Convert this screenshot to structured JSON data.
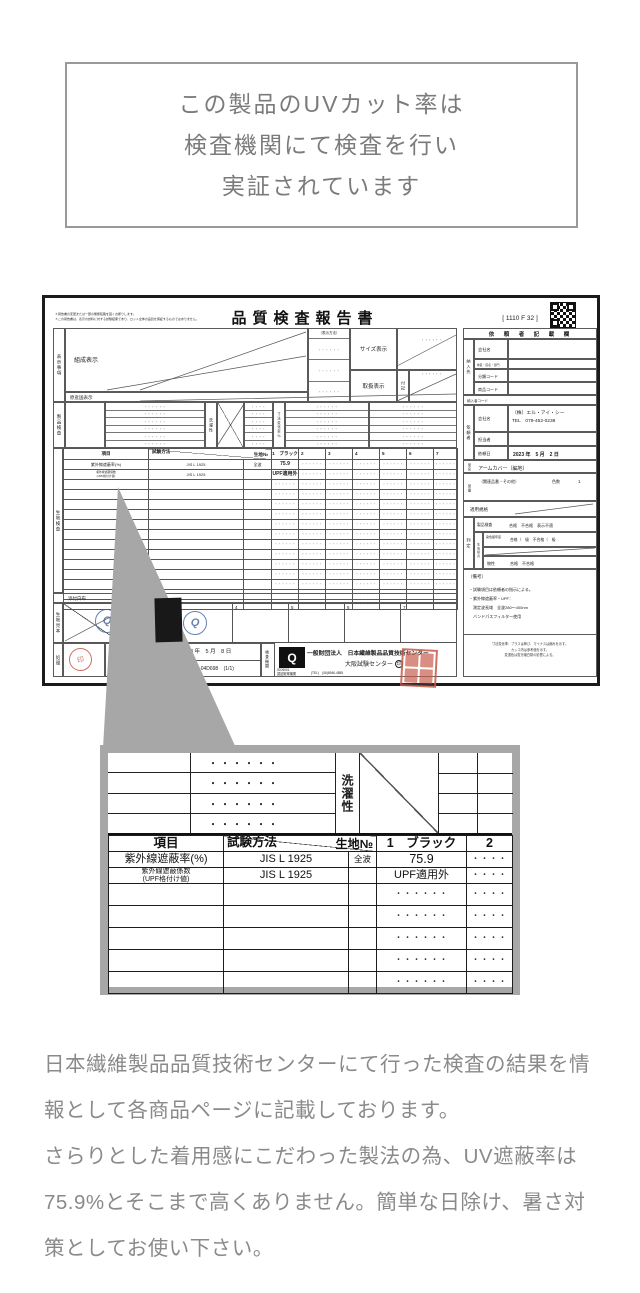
{
  "colors": {
    "frame_gray": "#a7a7a7",
    "text_gray": "#8a8a8a",
    "doc_border": "#1b1b1b",
    "stamp_red": "#c75948",
    "stamp_blue": "#40659a",
    "swatch_black": "#181818"
  },
  "intro_box": {
    "lines": [
      "この製品のUVカット率は",
      "検査機関にて検査を行い",
      "実証されています"
    ]
  },
  "report": {
    "title": "品質検査報告書",
    "form_code": "[ 1110 F 32 ]",
    "fine_print": [
      "＊報告書の変更または一部の無断転載を固くお断りします。",
      "＊この報告書は、表示の試料に対する試験結果であり、ロット全体の品質を保証するものではありません。"
    ],
    "labels": {
      "hyoji_jiko": "表示事項",
      "kosei": "組成表示",
      "gensankoku": "原産国表示",
      "hyoji_hoho": "（表示方法）",
      "size": "サイズ表示",
      "toriatsukai": "取扱表示",
      "fuki": "付記",
      "seihin_kensa": "製品検査",
      "sentakusei": "洗濯性",
      "sunpo": "寸法変化率％",
      "kiji_kensa": "生地検査",
      "tenpu": "添付白布",
      "kiji_mihon": "生地見本",
      "shori": "処理",
      "kensa_kikan": "検査機関"
    },
    "test_table": {
      "headers": {
        "item": "項目",
        "method": "試験方法",
        "fabric_no": "生地№",
        "col1": "1　ブラック",
        "cols": [
          "2",
          "3",
          "4",
          "5",
          "6",
          "7"
        ]
      },
      "rows": [
        {
          "item": "紫外線遮蔽率(%)",
          "method": "JIS L 1925",
          "sub": "全波",
          "value": "75.9"
        },
        {
          "item": "紫外線遮蔽係数",
          "item2": "(UPF格付け値)",
          "method": "JIS L 1925",
          "sub": "",
          "value": "UPF適用外"
        }
      ],
      "filler_rows": 13,
      "filler": "・・・・・・",
      "filler_small": "・・・・"
    },
    "client": {
      "heading": "依　頼　者　記　載　欄",
      "nounyu_label": "納入先",
      "nounyu_rows": [
        "会社名",
        "地区・店名・部門",
        "分類コード",
        "商品コード"
      ],
      "nounyusha_code": "納入者コード",
      "irai_label": "依頼者",
      "company_label": "会社名",
      "company": "（株）エル・アイ・シー",
      "tel": "TEL　079-452-0238",
      "tanto_label": "担当者",
      "date_label": "依頼日",
      "date": "2023 年　5 月　2 日",
      "hinmei_label": "品名",
      "hinmei": "アームカバー（編地）",
      "hinban_label": "品番",
      "hinban_related": "（関連品番・その他）",
      "color_label": "色数",
      "color_count": "1",
      "tekiyo": "適用規格",
      "hantei_label": "判定",
      "kiji_sub": "生地検査",
      "hantei_rows": [
        {
          "label": "製品検査",
          "value": "合格　不合格　表示不適"
        },
        {
          "label": "染色堅牢度",
          "value": "合格（　級　不合格（　級"
        },
        {
          "label": "物性",
          "value": "合格　不合格"
        }
      ],
      "biko_label": "（備考）",
      "biko_lines": [
        "・試験項目は依頼者の指示による。",
        "・紫外線遮蔽率・UPF：",
        "　測定波長域　全波280〜400nm",
        "　バンドパスフィルター使用"
      ],
      "note_lines": [
        "寸法変化率：プラスは伸び、マイナスは縮みを示す。",
        "カッコ内は参考値を示す。",
        "変退色は蛍光増白剤の影響による。"
      ]
    },
    "footer_row": {
      "date": "2023 年　5 月　8 日",
      "number": "№ 23-CS-04D698",
      "pages": "(1/1)",
      "org": "一般財団法人　日本繊維製品品質技術センター",
      "branch": "大阪試験センター",
      "in_mark": "印",
      "iso1": "ISO9001",
      "iso2": "認証取得機関",
      "tel": "(TEL)　(06)6946-4855",
      "q_logo": "Q",
      "stamp_text": "印",
      "swatch_numbers": [
        "2",
        "3",
        "4",
        "5",
        "6",
        "7"
      ]
    }
  },
  "detail_box": {
    "washing": "洗濯性",
    "dots6": "・・・・・・",
    "dots4": "・・・・",
    "headers": {
      "item": "項目",
      "method": "試験方法",
      "fabric_no": "生地№",
      "col1": "1　ブラック",
      "col2": "2"
    },
    "rows": [
      {
        "item": "紫外線遮蔽率(%)",
        "method": "JIS L 1925",
        "sub": "全波",
        "v1": "75.9",
        "v2": "・・・・"
      },
      {
        "item": "紫外線遮蔽係数",
        "item2": "(UPF格付け値)",
        "method": "JIS L 1925",
        "sub": "",
        "v1": "UPF適用外",
        "v2": "・・・・"
      }
    ],
    "empty_rows": 5
  },
  "footer": {
    "paragraphs": [
      "日本繊維製品品質技術センターにて行った検査の結果を情報として各商品ページに記載しております。",
      "さらりとした着用感にこだわった製法の為、UV遮蔽率は75.9%とそこまで高くありません。簡単な日除け、暑さ対策としてお使い下さい。"
    ]
  }
}
